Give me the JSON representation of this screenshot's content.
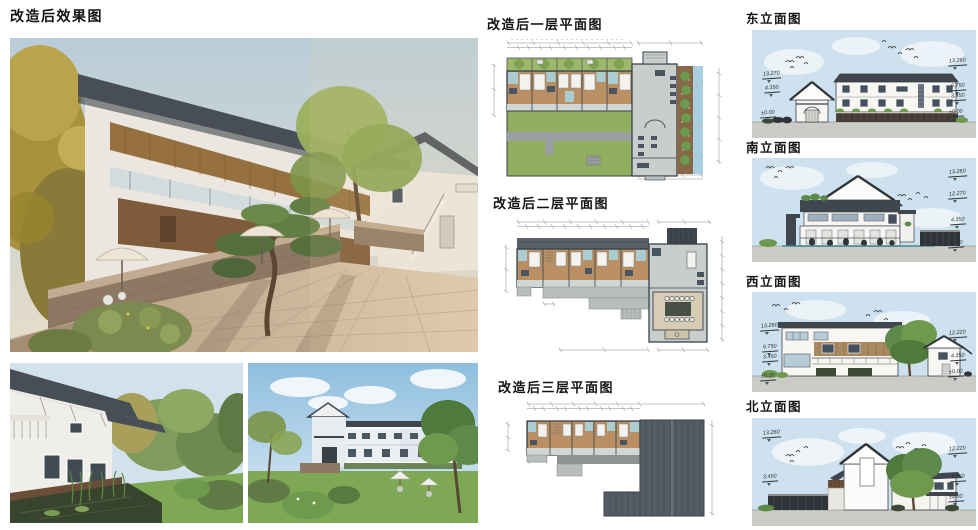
{
  "sections": {
    "renders": {
      "title": "改造后效果图"
    },
    "plans": [
      {
        "title": "改造后一层平面图"
      },
      {
        "title": "改造后二层平面图"
      },
      {
        "title": "改造后三层平面图"
      }
    ]
  },
  "elevations": [
    {
      "id": "east",
      "title": "东立面图",
      "markers_left": [
        "13.270",
        "4.350",
        "±0.00"
      ],
      "markers_right": [
        "13.260",
        "6.750",
        "3.450",
        "±0.00"
      ]
    },
    {
      "id": "south",
      "title": "南立面图",
      "markers_left": [],
      "markers_right": [
        "13.260",
        "12.270",
        "4.350",
        "±0.00"
      ]
    },
    {
      "id": "west",
      "title": "西立面图",
      "markers_left": [
        "13.260",
        "6.750",
        "3.450",
        "±0.00"
      ],
      "markers_right": [
        "12.220",
        "4.350",
        "±0.00"
      ]
    },
    {
      "id": "north",
      "title": "北立面图",
      "markers_left": [
        "13.260",
        "3.450"
      ],
      "markers_right": [
        "12.220",
        "4.350",
        "±0.00"
      ]
    }
  ],
  "colors": {
    "roof_dark": "#3f464d",
    "wood_panel": "#96703f",
    "plan_lawn": "#90ad60",
    "render_lawn": "#7fa855",
    "plan_floor_wood": "#b98f63",
    "plan_bath": "#a9cdd0",
    "plan_water": "#a8cfdd",
    "sky_watercolor": "#cde2ee",
    "stone_wall": "#8d7864"
  }
}
